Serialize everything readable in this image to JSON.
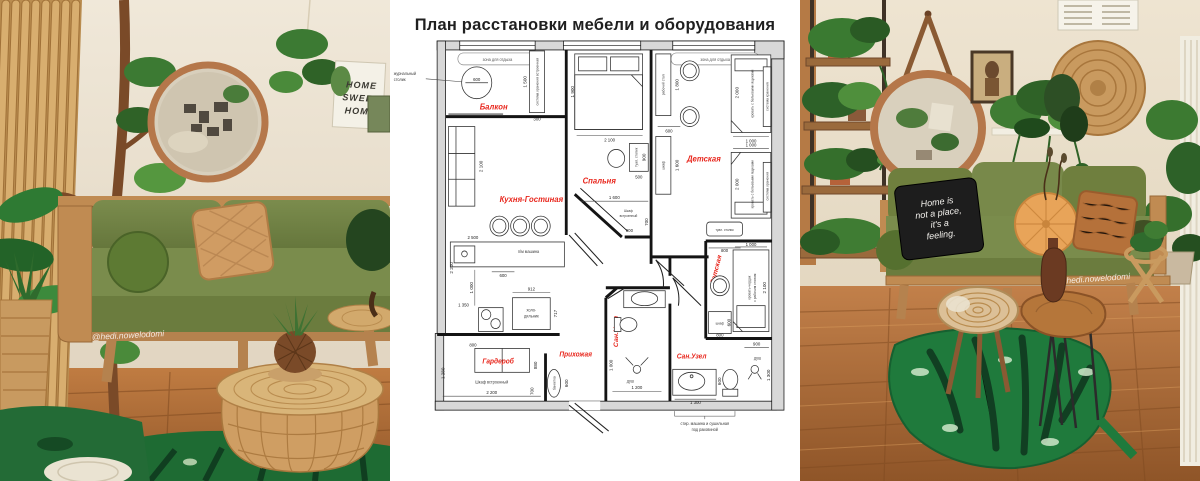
{
  "title": "План расстановки мебели и оборудования",
  "plan": {
    "rooms": {
      "balcony": "Балкон",
      "bedroom": "Спальня",
      "kids": "Детская",
      "kitchen_living": "Кухня-Гостиная",
      "wardrobe": "Гардероб",
      "hallway": "Прихожая",
      "bathroom1": "Сан.Узел",
      "bathroom2": "Сан.Узел",
      "kids2": "Детская"
    },
    "zone_label": "зона для отдыха",
    "labels": {
      "coffee_table": [
        "журнальный",
        "столик"
      ],
      "storage_builtin": "система хранения встроенная",
      "dishwasher": "п/м машина",
      "fridge": [
        "холо-",
        "дильник"
      ],
      "vanity": "туал. столик",
      "desk": "рабочий стол",
      "closet": "шкаф",
      "bed_drawers": "кровать с бельевыми ящиками",
      "storage": "система хранения",
      "loft_bed": [
        "кровать-чердак",
        "с рабочим столом"
      ],
      "builtin_closet": "Шкаф встроенный",
      "builtin_closet_lines": [
        "Шкаф",
        "встроенный"
      ],
      "bench": "банкетка",
      "shower": "душ",
      "washer_note": [
        "стир. машина и сушильная",
        "под раковиной"
      ]
    },
    "dims": {
      "balcony_table": "600",
      "storage_h": "1 500",
      "storage_w": "300",
      "sofa": "2 100",
      "kitchen": "2 500",
      "kitchen_600": "600",
      "kitchen_col": "1 000",
      "left_wall": "2 200",
      "fridge_w": "912",
      "fridge_d": "717",
      "stove": "1 350",
      "wardrobe_800": "800",
      "wardrobe_1280": "1 280",
      "wardrobe_880": "880",
      "wardrobe_700": "700",
      "wardrobe_2200": "2 200",
      "bench_600": "600",
      "bed_1900": "1 900",
      "bed_2100": "2 100",
      "vanity_900": "900",
      "vanity_500": "500",
      "bedroom_1600": "1 600",
      "bedroom_700": "700",
      "bedroom_900": "900",
      "desk_1800": "1 800",
      "desk_600": "600",
      "closet_1600": "1 600",
      "bed1_2000": "2 000",
      "bed1_1000": "1 000",
      "bed2_1000": "1 000",
      "bed2_2000": "2 000",
      "kids2_800": "800",
      "loft_1000": "1 000",
      "loft_2100": "2 100",
      "kids2_closet_600": "600",
      "kids2_closet_800": "800",
      "bath2_900": "900",
      "bath2_1300v": "1 300",
      "bath2_600": "600",
      "bath2_1300": "1 300",
      "bath1_1000": "1 000",
      "bath1_1200": "1 200"
    }
  },
  "left_photo": {
    "sign": [
      "HOME",
      "SWEET",
      "HOME"
    ],
    "watermark": "@hedi.nowelodomi"
  },
  "right_photo": {
    "pillow": [
      "Home is",
      "not a place,",
      "it's a",
      "feeling."
    ],
    "watermark": "@hedi.nowelodomi"
  }
}
